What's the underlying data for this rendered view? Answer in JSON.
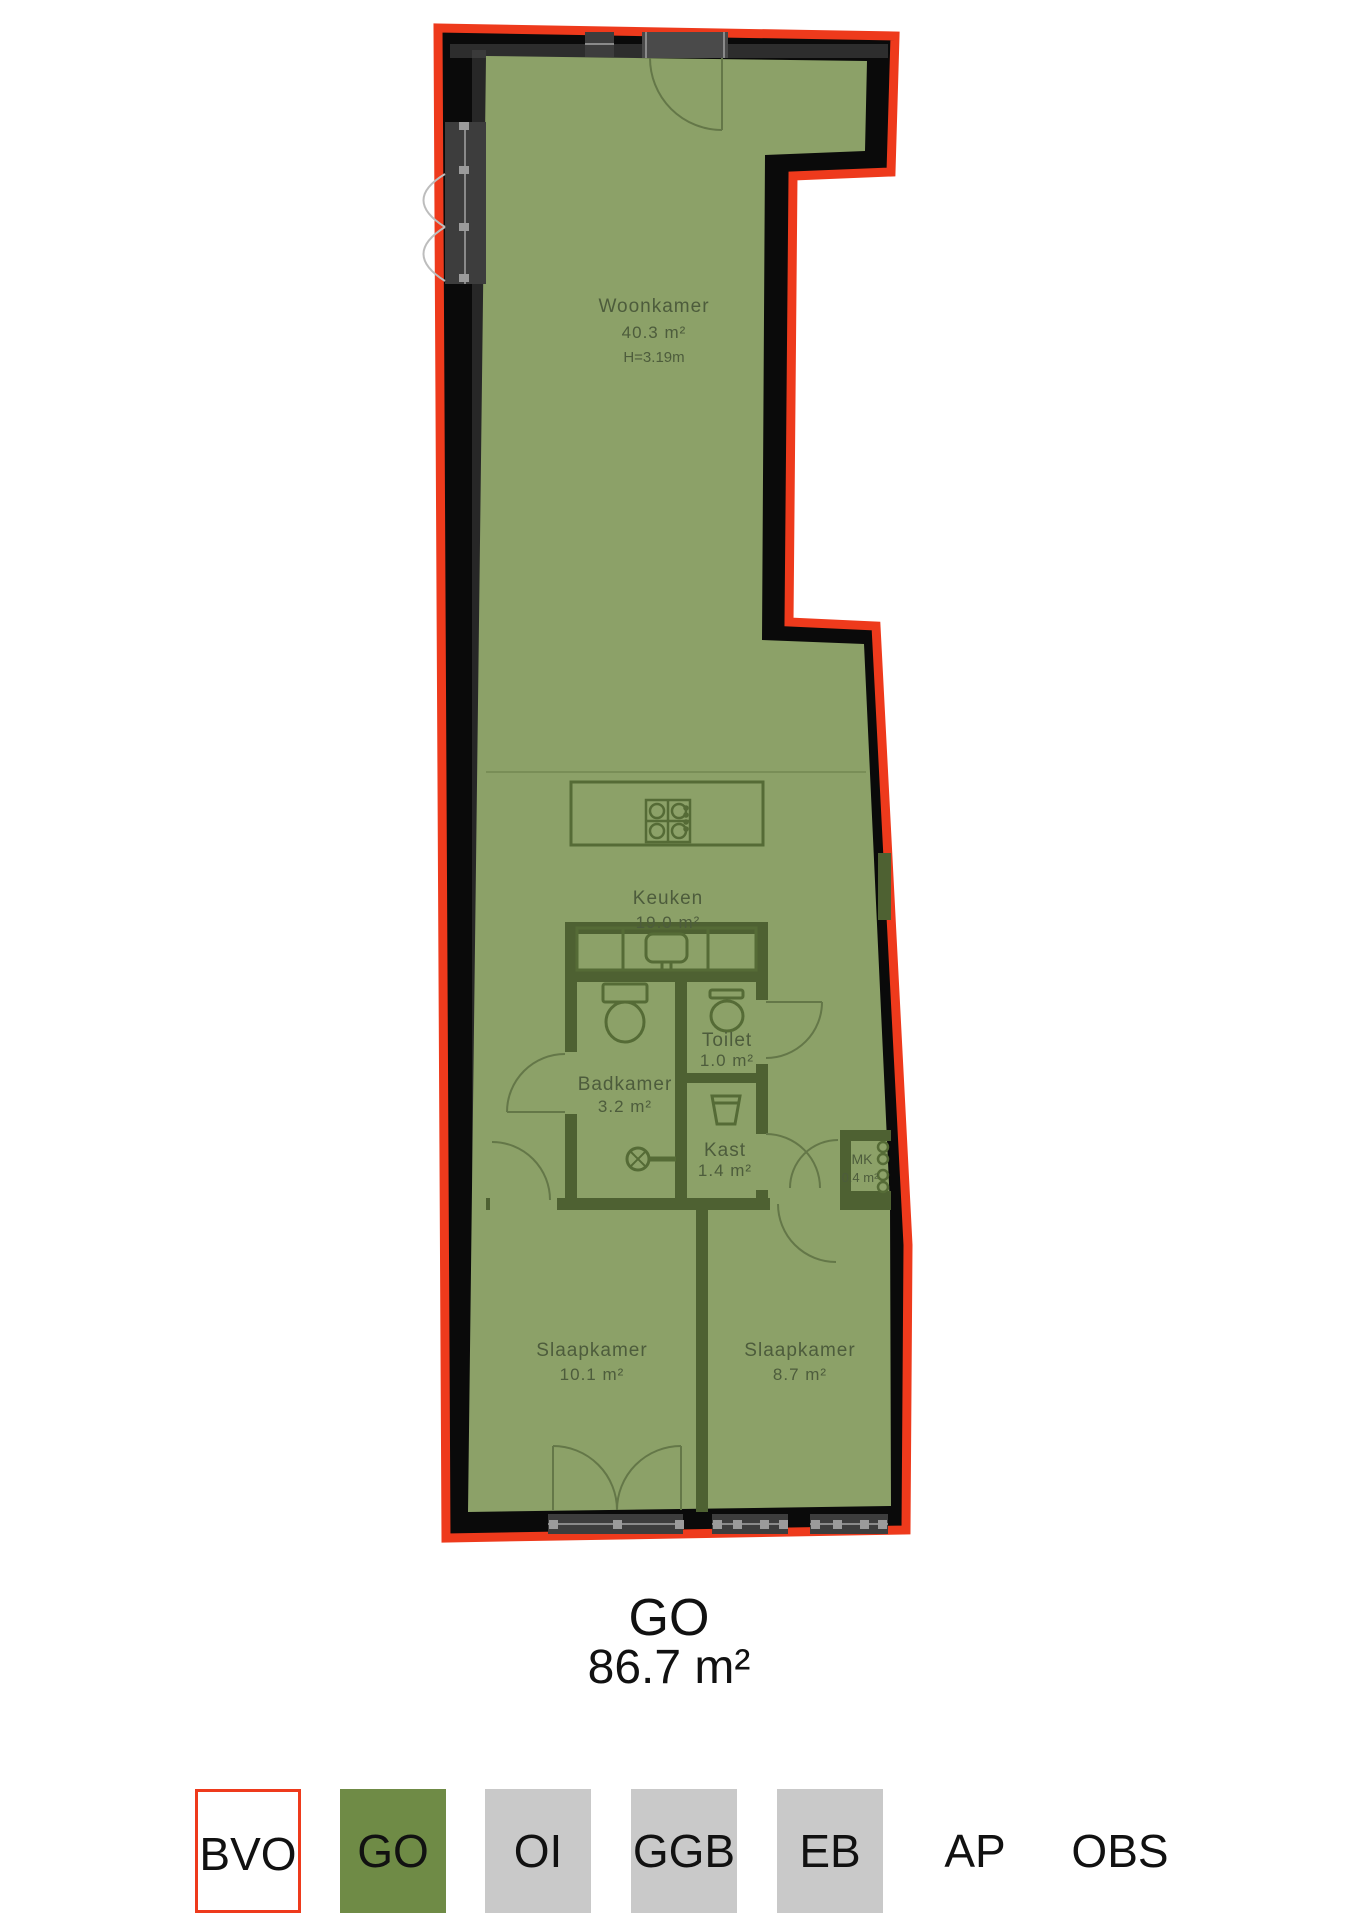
{
  "floorplan": {
    "rooms": [
      {
        "name": "Woonkamer",
        "area": "40.3 m²",
        "ceiling": "H=3.19m"
      },
      {
        "name": "Keuken",
        "area": "19.0 m²"
      },
      {
        "name": "Badkamer",
        "area": "3.2 m²"
      },
      {
        "name": "Toilet",
        "area": "1.0 m²"
      },
      {
        "name": "Kast",
        "area": "1.4 m²"
      },
      {
        "name": "MK",
        "area": "0.4 m²"
      },
      {
        "name": "Slaapkamer",
        "area": "10.1 m²"
      },
      {
        "name": "Slaapkamer2",
        "area2": "8.7 m²",
        "name2": "Slaapkamer"
      }
    ],
    "summary": {
      "code": "GO",
      "area": "86.7 m²"
    },
    "legend": {
      "items": [
        {
          "label": "BVO"
        },
        {
          "label": "GO"
        },
        {
          "label": "OI"
        },
        {
          "label": "GGB"
        },
        {
          "label": "EB"
        },
        {
          "label": "AP"
        },
        {
          "label": "OBS"
        }
      ]
    },
    "colors": {
      "bvo_outline_red": "#ee3a1c",
      "go_area_green": "#8ca168",
      "outer_wall_black": "#0a0a0a",
      "inner_wall_olive": "#4e6132",
      "legend_go_green": "#6f8b46",
      "legend_gray": "#c9c9c9",
      "window_gray": "#3d3d3d"
    }
  }
}
